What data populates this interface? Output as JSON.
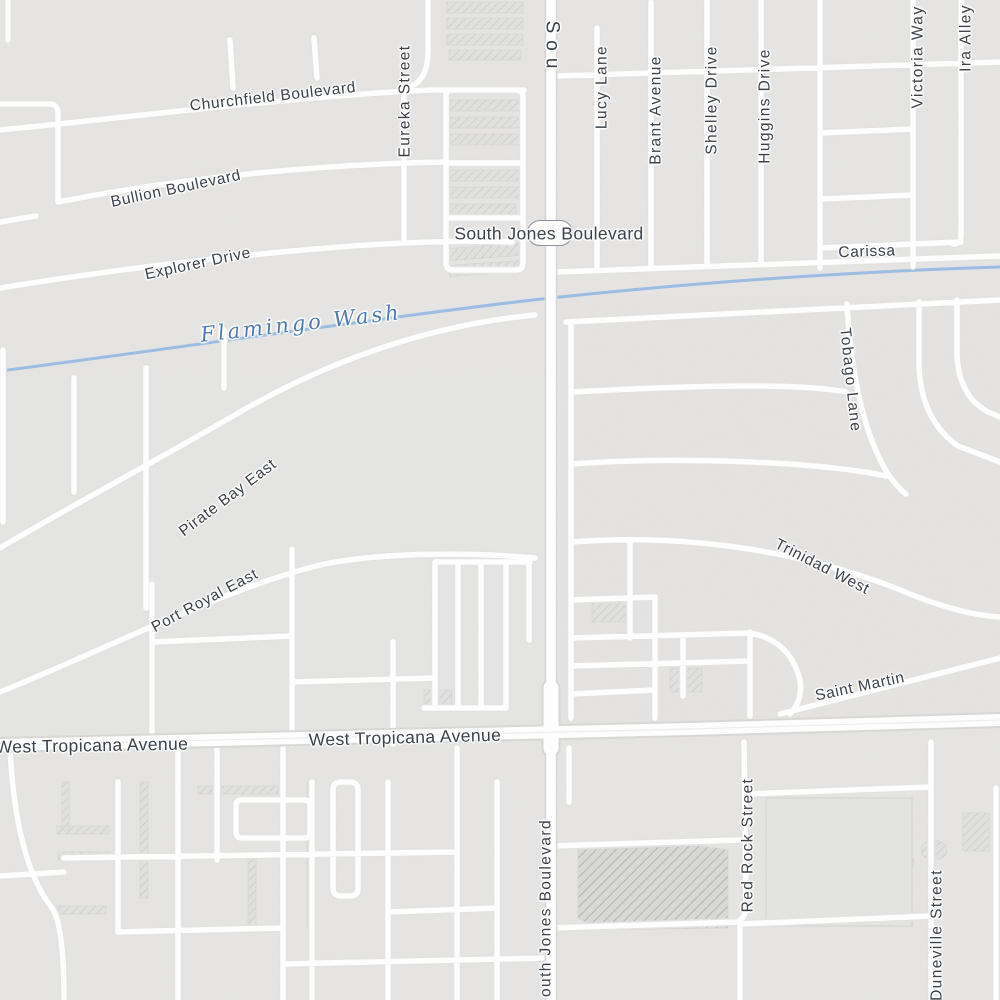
{
  "map": {
    "labels": {
      "churchfield_boulevard": "Churchfield Boulevard",
      "bullion_boulevard": "Bullion Boulevard",
      "explorer_drive": "Explorer Drive",
      "eureka_street": "Eureka Street",
      "south_jones_boulevard": "South Jones Boulevard",
      "south_jones_top_fragment": "Sou",
      "south_jones_bottom_fragment": "outh Jones Boulevard",
      "lucy_lane": "Lucy Lane",
      "brant_avenue": "Brant Avenue",
      "shelley_drive": "Shelley Drive",
      "huggins_drive": "Huggins Drive",
      "victoria_way": "Victoria Way",
      "ira_alley": "Ira Alley",
      "carissa": "Carissa",
      "flamingo_wash": "Flamingo Wash",
      "pirate_bay_east": "Pirate Bay East",
      "port_royal_east": "Port Royal East",
      "tobago_lane": "Tobago Lane",
      "trinidad_west": "Trinidad West",
      "saint_martin": "Saint Martin",
      "west_tropicana_avenue_left": "West Tropicana Avenue",
      "west_tropicana_avenue_center": "West Tropicana Avenue",
      "red_rock_street": "Red Rock Street",
      "duneville_street": "Duneville Street"
    },
    "features": {
      "waterway": "Flamingo Wash",
      "route_shield_text": ""
    },
    "colors": {
      "background": "#e8e7e5",
      "road_fill": "#fdfdfd",
      "road_casing_minor": "#e2e2e0",
      "road_casing_major": "#d7d7d5",
      "building_fill": "#e0e0de",
      "building_hatch": "#cbcbc9",
      "building_dark_hatch": "#b3b3b1",
      "water": "#9cbce2",
      "water_label": "#4f7cb5",
      "street_label": "#3b424a",
      "shield_border": "#8d939a"
    }
  }
}
